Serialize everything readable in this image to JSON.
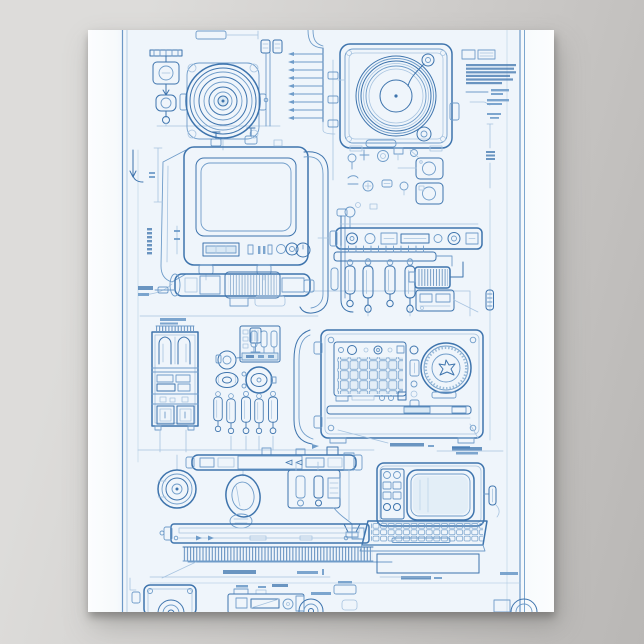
{
  "scene": {
    "type": "poster product photo",
    "description": "Blueprint-style line-art poster of vintage electronics hung on a plain gray wall, bottom of print cropped",
    "wall": "plain gray with soft gradient",
    "shadow": "soft drop shadow below and right of the poster"
  },
  "palette": {
    "background_top": "#dddcda",
    "background_bottom": "#b9b7b5",
    "paper": "#f9fbfd",
    "paper_tint": "#eff5fb",
    "line_strong": "#3e74ad",
    "line_medium": "#6f9cc9",
    "line_faint": "#a8c4e0",
    "fill_screen": "#a9c7e1",
    "fill_light": "#d9e8f4",
    "shadow": "#9b9997"
  },
  "poster": {
    "style": "blueprint technical illustration, blue ink on pale blue paper",
    "border": "thin double blue rule on left and right margins",
    "annotations": "numerous tiny illegible callout texts, leader lines and dimension marks",
    "figures": [
      {
        "name": "top-left-fitting",
        "label": "Stacked pipe fitting and valve parts"
      },
      {
        "name": "speaker-fan",
        "label": "Round speaker driver on mounting plate"
      },
      {
        "name": "connector-wires",
        "label": "Twin wires with square terminals"
      },
      {
        "name": "pin-ladder",
        "label": "Ladder row of connector pins"
      },
      {
        "name": "turntable",
        "label": "Record turntable deck with tonearm"
      },
      {
        "name": "spec-text-block",
        "label": "Specification note block with dimension line"
      },
      {
        "name": "crt-tv",
        "label": "CRT television set with hatched screen and knobs"
      },
      {
        "name": "pipe-run",
        "label": "Curved conduit pipes"
      },
      {
        "name": "small-parts",
        "label": "Assorted knobs, bolts and bezel plates"
      },
      {
        "name": "control-faceplate",
        "label": "Long control faceplate bar"
      },
      {
        "name": "vacuum-tubes",
        "label": "Rail with hanging vacuum-tube components"
      },
      {
        "name": "transformer",
        "label": "Hatched transformer box and slotted chassis box"
      },
      {
        "name": "shaft-assembly",
        "label": "Horizontal shaft / roller assembly"
      },
      {
        "name": "parts-cabinet",
        "label": "Tall compartment parts cabinet"
      },
      {
        "name": "gauge-column",
        "label": "Valve, grommet, round gauge and capacitor column"
      },
      {
        "name": "radio-unit",
        "label": "Radio unit with keypad grid and round speaker"
      },
      {
        "name": "drive-assembly",
        "label": "Pulley wheel, motor and valve drive assembly"
      },
      {
        "name": "heat-sink",
        "label": "Finned vent strip"
      },
      {
        "name": "computer-terminal",
        "label": "Computer terminal with monitor, keyboard and vent"
      },
      {
        "name": "bottom-devices",
        "label": "Cropped row: square speaker, tape deck, round speakers"
      },
      {
        "name": "callouts",
        "label": "Dimension lines and illegible annotation text"
      }
    ]
  }
}
